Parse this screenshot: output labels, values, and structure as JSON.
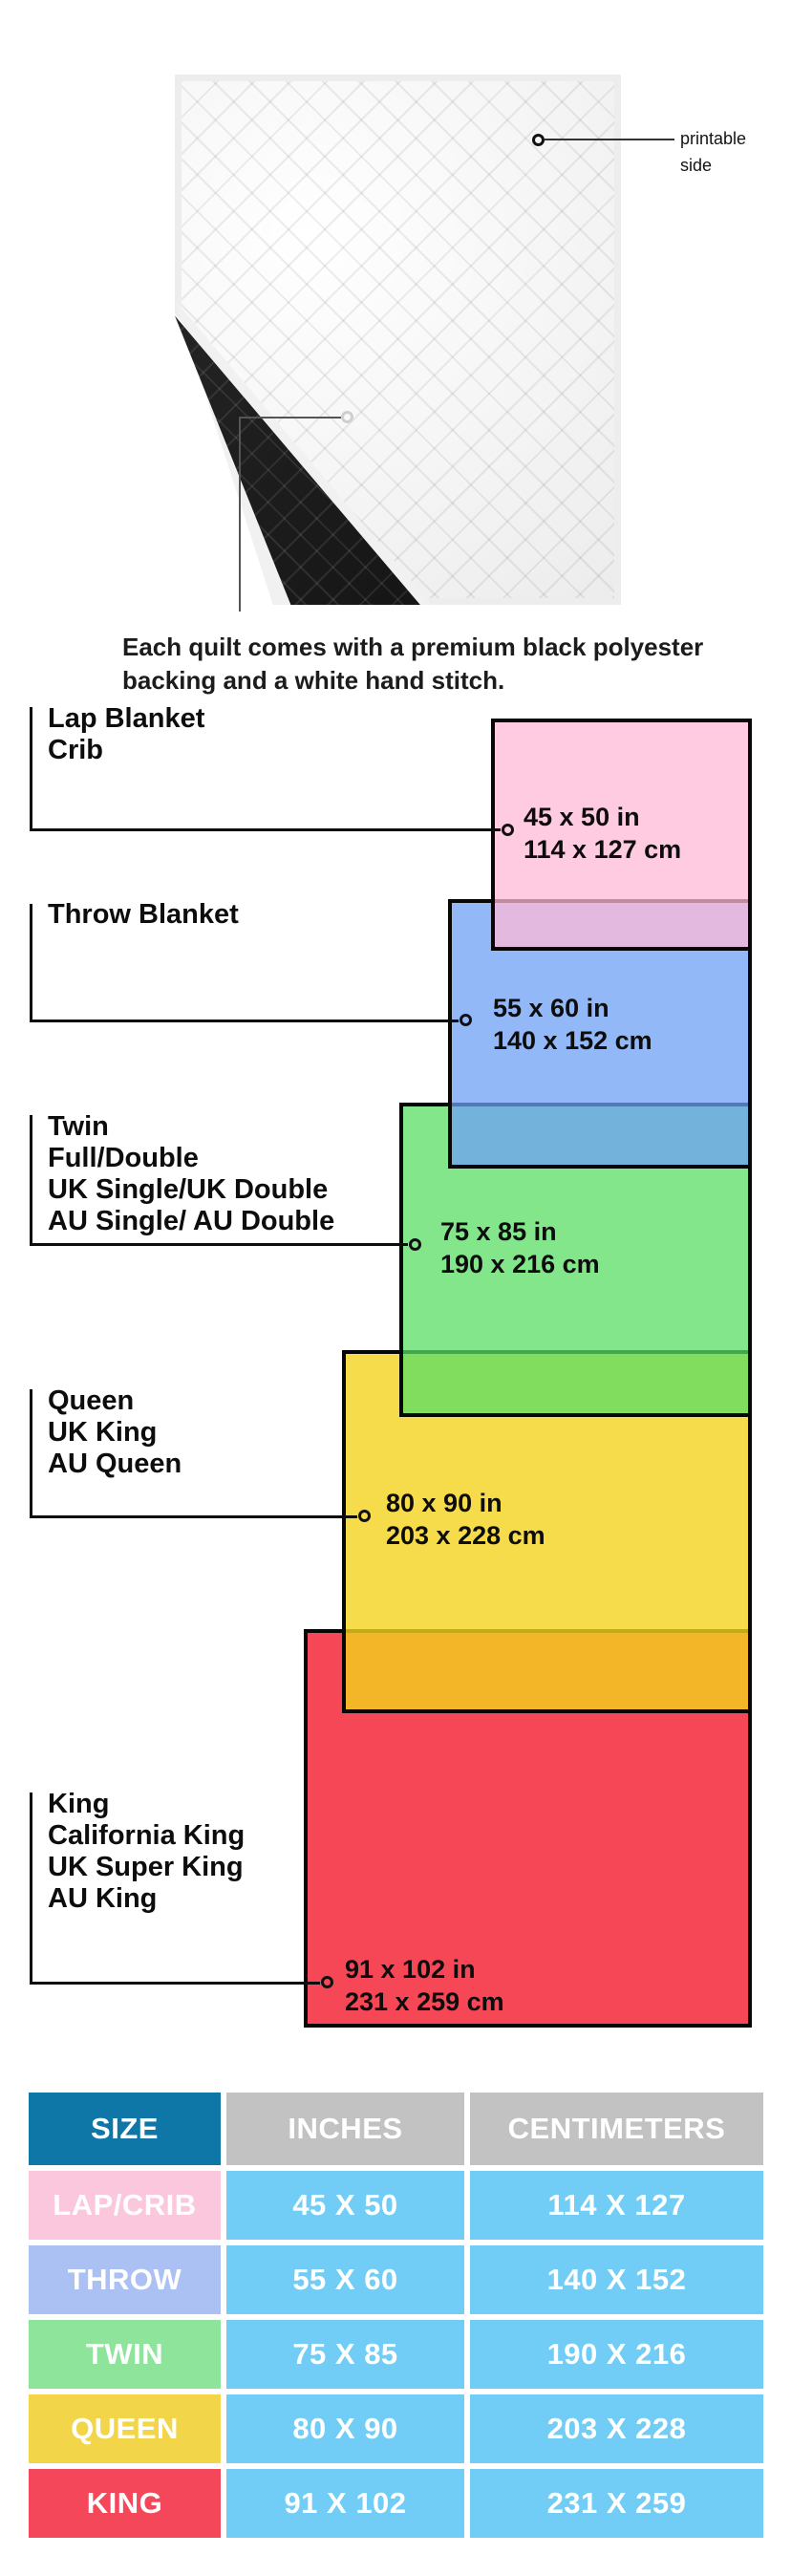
{
  "quilt": {
    "printable_label_line1": "printable",
    "printable_label_line2": "side",
    "caption_line1": "Each quilt comes with a premium black polyester",
    "caption_line2": "backing and a white hand stitch.",
    "front_color": "#FFFFFF",
    "backing_color": "#151515"
  },
  "diagram": {
    "items": [
      {
        "id": "lap",
        "labels": [
          "Lap Blanket",
          "Crib"
        ],
        "inches": "45 x 50 in",
        "cm": "114 x 127 cm",
        "color": "#FFC9DE"
      },
      {
        "id": "throw",
        "labels": [
          "Throw Blanket"
        ],
        "inches": "55 x 60 in",
        "cm": "140 x 152 cm",
        "color": "#9FC2F5"
      },
      {
        "id": "twin",
        "labels": [
          "Twin",
          "Full/Double",
          "UK Single/UK Double",
          "AU Single/ AU Double"
        ],
        "inches": "75 x 85 in",
        "cm": "190 x 216 cm",
        "color": "#95E59D"
      },
      {
        "id": "queen",
        "labels": [
          "Queen",
          "UK King",
          "AU Queen"
        ],
        "inches": "80 x 90 in",
        "cm": "203 x 228 cm",
        "color": "#F5D840"
      },
      {
        "id": "king",
        "labels": [
          "King",
          "California King",
          "UK Super King",
          "AU King"
        ],
        "inches": "91 x 102 in",
        "cm": "231 x 259 cm",
        "color": "#F54955"
      }
    ],
    "overlap_colors": {
      "lap_over_throw": "#E4B8DF",
      "throw_over_twin": "#87B2DD",
      "twin_over_queen": "#81DD5F",
      "queen_over_king": "#F4B729"
    },
    "border_color": "#000000"
  },
  "table": {
    "headers": [
      "SIZE",
      "INCHES",
      "CENTIMETERS"
    ],
    "header_colors": {
      "size": "#0F76A8",
      "data": "#C2C2C2"
    },
    "value_cell_color": "#72CDF6",
    "rows": [
      {
        "size": "LAP/CRIB",
        "inches": "45 X 50",
        "cm": "114 X 127",
        "label_color": "#FBC7DC"
      },
      {
        "size": "THROW",
        "inches": "55 X 60",
        "cm": "140 X 152",
        "label_color": "#ABC1F3"
      },
      {
        "size": "TWIN",
        "inches": "75 X 85",
        "cm": "190 X 216",
        "label_color": "#8FE49B"
      },
      {
        "size": "QUEEN",
        "inches": "80 X 90",
        "cm": "203 X 228",
        "label_color": "#F3D54A"
      },
      {
        "size": "KING",
        "inches": "91 X 102",
        "cm": "231 X 259",
        "label_color": "#F4485A"
      }
    ]
  }
}
